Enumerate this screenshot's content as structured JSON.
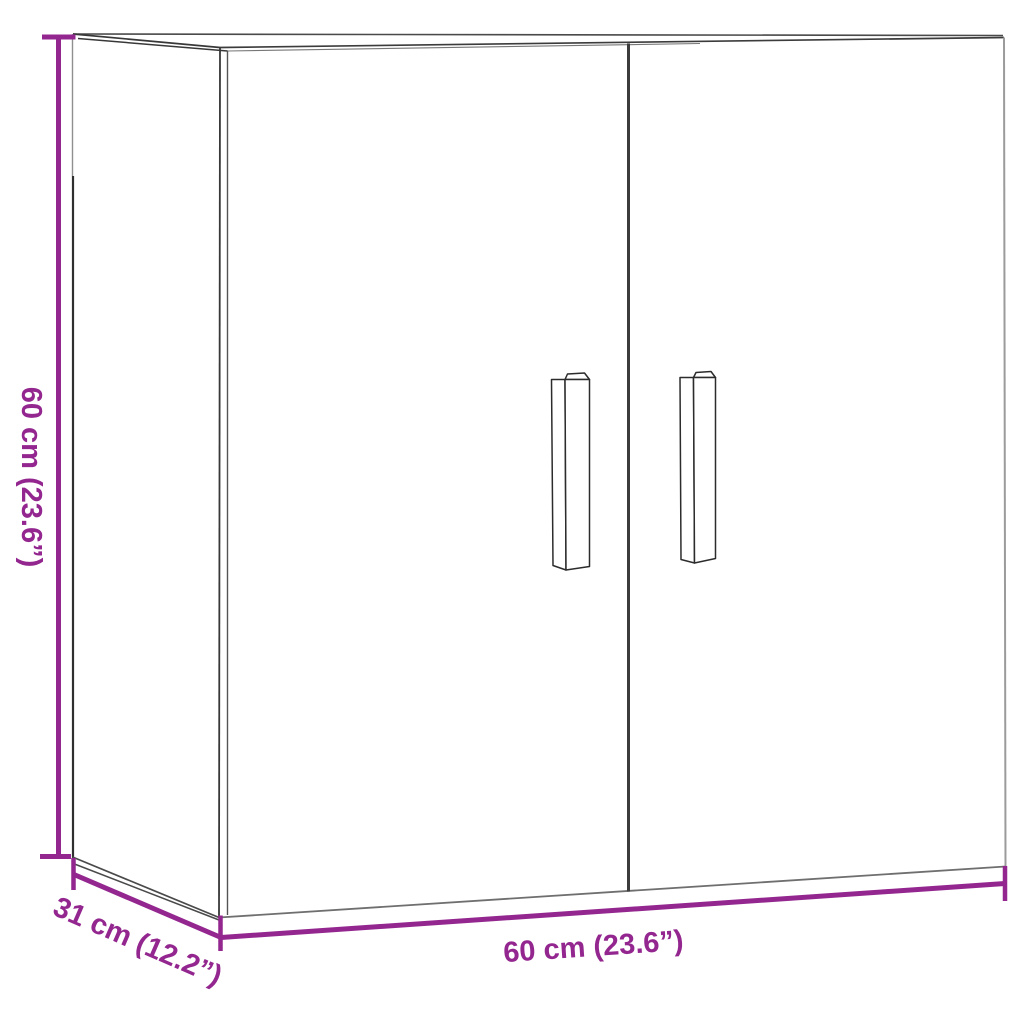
{
  "diagram": {
    "kind": "product-dimension-diagram",
    "product_name": "two-door wall cabinet",
    "background_color": "#ffffff",
    "accent_color": "#93278F",
    "outline_color": "#3c3c3c"
  },
  "dimensions": {
    "height": {
      "label": "60 cm (23.6”)",
      "cm": "60",
      "inches": "23.6"
    },
    "depth": {
      "label": "31 cm (12.2”)",
      "cm": "31",
      "inches": "12.2"
    },
    "width": {
      "label": "60 cm (23.6”)",
      "cm": "60",
      "inches": "23.6"
    }
  }
}
